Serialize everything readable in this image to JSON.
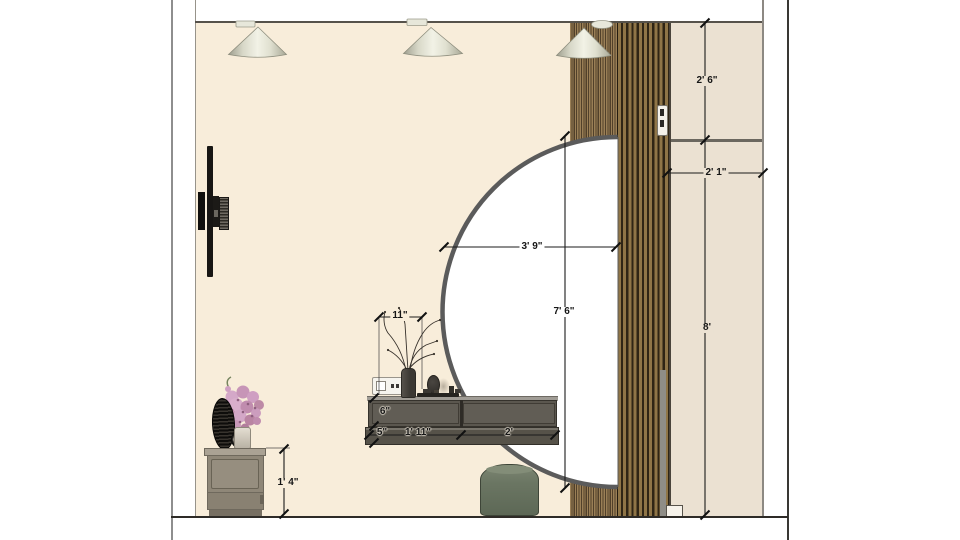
{
  "page": {
    "type": "interior-elevation-drawing",
    "background": "#ffffff",
    "view": "bedroom vanity wall elevation"
  },
  "drawing": {
    "annotations": {
      "panel_above_door": "2' 6\"",
      "column_width": "2' 1\"",
      "door_height": "8'",
      "mirror_radius": "3' 9\"",
      "mirror_height": "7' 6\"",
      "vase_width": "11\"",
      "counter_upper_height": "6\"",
      "counter_lower_height": "5\"",
      "drawer_left_width": "1' 11\"",
      "drawer_right_width": "2'",
      "nightstand_height": "1' 4\""
    },
    "objects": {
      "pendant_lights": "cone-pendant-light",
      "slat_panel": "wood-slat-accent-panel",
      "mirror": "half-round-arch-mirror",
      "vanity": "floating-vanity-counter",
      "outlet": "wall-power-outlet",
      "branch_vase": "vase-with-dry-branches",
      "table_mirror": "small-oval-table-mirror",
      "tray": "vanity-tray",
      "pouf": "round-pouf-stool",
      "nightstand": "low-nightstand",
      "flower_vase": "pink-flower-vase",
      "black_decor": "round-black-decor",
      "tv": "wall-mounted-tv-side-view",
      "door": "wardrobe-door-panel",
      "handle": "recessed-door-handle"
    },
    "colors": {
      "wall": "#f8edda",
      "slats_light": "#9a7f56",
      "slats_dark": "#8f7547",
      "door_panel": "#ebe1d2",
      "counter": "#5a564f",
      "pouf": "#6b7663",
      "flowers": "#d2a5c6",
      "cone_light": "#e8e8da",
      "dimension_text": "#151515"
    }
  }
}
